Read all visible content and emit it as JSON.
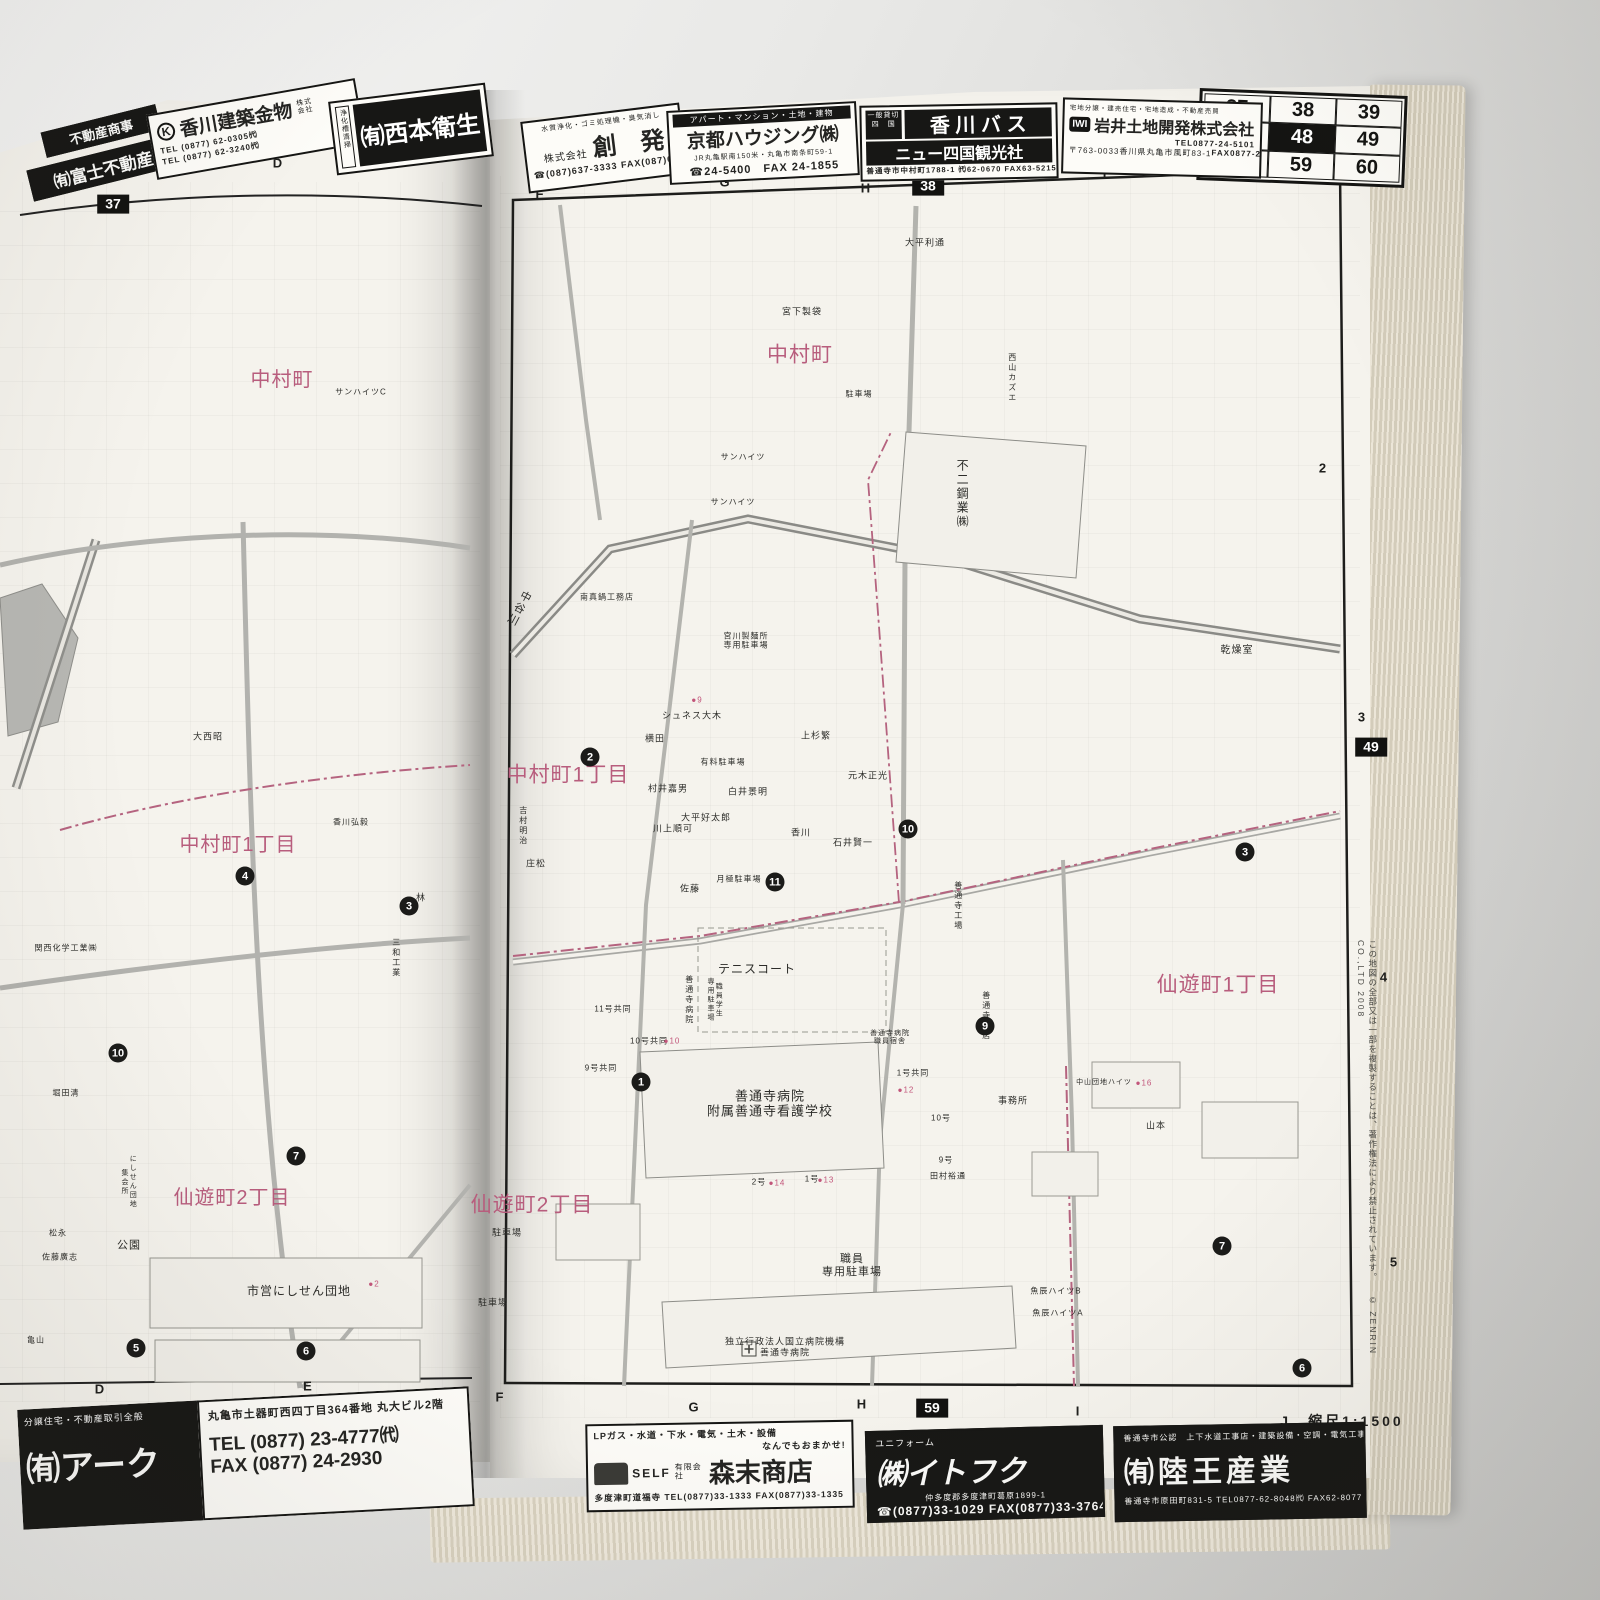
{
  "colors": {
    "pink": "#b85d7d",
    "red_dot": "#c2557a",
    "ink": "#1d1d1b",
    "page": "#f5f3ed"
  },
  "atlas": {
    "city": "善通寺市",
    "scale": "J　縮尺1:1500",
    "copyright_jp": "この地図の全部又は一部を複製することは、著作権法により禁止されています。",
    "copyright_en": "© ZENRIN CO.,LTD 2008"
  },
  "grid_index": {
    "cells": [
      {
        "text": "37"
      },
      {
        "text": "38"
      },
      {
        "text": "39"
      },
      {
        "text": "47"
      },
      {
        "text": "48",
        "active": true
      },
      {
        "text": "49"
      },
      {
        "text": "58"
      },
      {
        "text": "59"
      },
      {
        "text": "60"
      }
    ]
  },
  "page_boxes": [
    {
      "text": "37",
      "x": 113,
      "y": 204
    },
    {
      "text": "38",
      "x": 928,
      "y": 186
    },
    {
      "text": "49",
      "x": 1371,
      "y": 747
    },
    {
      "text": "59",
      "x": 932,
      "y": 1408
    }
  ],
  "grid_marks": [
    {
      "text": "D",
      "x": 278,
      "y": 163
    },
    {
      "text": "F",
      "x": 540,
      "y": 194
    },
    {
      "text": "G",
      "x": 725,
      "y": 182
    },
    {
      "text": "H",
      "x": 866,
      "y": 188
    },
    {
      "text": "I",
      "x": 1105,
      "y": 173
    },
    {
      "text": "J",
      "x": 1247,
      "y": 170
    },
    {
      "text": "善通寺市",
      "x": 1284,
      "y": 176,
      "size": 10
    },
    {
      "text": "2",
      "x": 1323,
      "y": 468
    },
    {
      "text": "3",
      "x": 1362,
      "y": 717
    },
    {
      "text": "4",
      "x": 1384,
      "y": 977
    },
    {
      "text": "5",
      "x": 1394,
      "y": 1262
    },
    {
      "text": "D",
      "x": 100,
      "y": 1389
    },
    {
      "text": "E",
      "x": 308,
      "y": 1386
    },
    {
      "text": "F",
      "x": 500,
      "y": 1397
    },
    {
      "text": "G",
      "x": 694,
      "y": 1407
    },
    {
      "text": "H",
      "x": 862,
      "y": 1404
    },
    {
      "text": "I",
      "x": 1078,
      "y": 1411
    }
  ],
  "right_map": {
    "labels": [
      {
        "text": "中村町",
        "x": 800,
        "y": 356,
        "size": 21,
        "color": "#b85d7d"
      },
      {
        "text": "中村町1丁目",
        "x": 568,
        "y": 776,
        "size": 21,
        "color": "#b85d7d"
      },
      {
        "text": "仙遊町1丁目",
        "x": 1218,
        "y": 986,
        "size": 21,
        "color": "#b85d7d"
      },
      {
        "text": "仙遊町2丁目",
        "x": 532,
        "y": 1206,
        "size": 21,
        "color": "#b85d7d"
      },
      {
        "text": "大平利通",
        "x": 925,
        "y": 243
      },
      {
        "text": "宮下製袋",
        "x": 802,
        "y": 312
      },
      {
        "text": "駐車場",
        "x": 859,
        "y": 394,
        "size": 8
      },
      {
        "text": "西山カズエ",
        "x": 1012,
        "y": 378,
        "vertical": true,
        "size": 8
      },
      {
        "text": "不二鋼業㈱",
        "x": 962,
        "y": 494,
        "vertical": true,
        "size": 12
      },
      {
        "text": "乾燥室",
        "x": 1237,
        "y": 651,
        "size": 10
      },
      {
        "text": "中谷川",
        "x": 518,
        "y": 608,
        "size": 11,
        "vertical": true,
        "rotate": 28
      },
      {
        "text": "南真鍋工務店",
        "x": 607,
        "y": 597,
        "size": 8
      },
      {
        "text": "サンハイツ",
        "x": 743,
        "y": 457,
        "size": 8
      },
      {
        "text": "サンハイツ",
        "x": 733,
        "y": 502,
        "size": 8
      },
      {
        "text": "宮川製麺所\n専用駐車場",
        "x": 746,
        "y": 641,
        "size": 8
      },
      {
        "text": "シュネス大木",
        "x": 692,
        "y": 716
      },
      {
        "text": "●9",
        "x": 697,
        "y": 700,
        "size": 8,
        "color": "#c2557a"
      },
      {
        "text": "有料駐車場",
        "x": 723,
        "y": 762,
        "size": 8
      },
      {
        "text": "横田",
        "x": 655,
        "y": 739
      },
      {
        "text": "村井嘉男",
        "x": 668,
        "y": 789
      },
      {
        "text": "白井景明",
        "x": 748,
        "y": 792
      },
      {
        "text": "大平好太郎",
        "x": 706,
        "y": 818
      },
      {
        "text": "川上順可",
        "x": 673,
        "y": 829
      },
      {
        "text": "上杉繁",
        "x": 816,
        "y": 736
      },
      {
        "text": "元木正光",
        "x": 868,
        "y": 776
      },
      {
        "text": "香川",
        "x": 801,
        "y": 833
      },
      {
        "text": "石井賢一",
        "x": 853,
        "y": 843
      },
      {
        "text": "月極駐車場",
        "x": 739,
        "y": 879,
        "size": 8
      },
      {
        "text": "佐藤",
        "x": 690,
        "y": 889
      },
      {
        "text": "庄松",
        "x": 536,
        "y": 864
      },
      {
        "text": "吉村明治",
        "x": 523,
        "y": 826,
        "vertical": true,
        "size": 8
      },
      {
        "text": "善通寺工場",
        "x": 958,
        "y": 906,
        "vertical": true,
        "size": 8
      },
      {
        "text": "善通寺支店",
        "x": 986,
        "y": 1016,
        "vertical": true,
        "size": 8
      },
      {
        "text": "テニスコート",
        "x": 757,
        "y": 969,
        "size": 12
      },
      {
        "text": "善通寺病院",
        "x": 689,
        "y": 1000,
        "vertical": true,
        "size": 8
      },
      {
        "text": "職員学生\n専用駐車場",
        "x": 714,
        "y": 1000,
        "vertical": true,
        "size": 7
      },
      {
        "text": "11号共同",
        "x": 613,
        "y": 1009,
        "size": 8
      },
      {
        "text": "10号共同",
        "x": 649,
        "y": 1041,
        "size": 8
      },
      {
        "text": "●10",
        "x": 672,
        "y": 1041,
        "size": 8,
        "color": "#c2557a"
      },
      {
        "text": "9号共同",
        "x": 601,
        "y": 1068,
        "size": 8
      },
      {
        "text": "善通寺病院\n職員宿舎",
        "x": 890,
        "y": 1038,
        "size": 7
      },
      {
        "text": "1号共同",
        "x": 913,
        "y": 1073,
        "size": 8
      },
      {
        "text": "●12",
        "x": 906,
        "y": 1090,
        "size": 8,
        "color": "#c2557a"
      },
      {
        "text": "10号",
        "x": 941,
        "y": 1118,
        "size": 8
      },
      {
        "text": "9号",
        "x": 946,
        "y": 1160,
        "size": 8
      },
      {
        "text": "田村裕通",
        "x": 948,
        "y": 1176,
        "size": 8
      },
      {
        "text": "善通寺病院\n附属善通寺看護学校",
        "x": 770,
        "y": 1104,
        "size": 13
      },
      {
        "text": "2号",
        "x": 759,
        "y": 1182,
        "size": 8
      },
      {
        "text": "●14",
        "x": 777,
        "y": 1183,
        "size": 8,
        "color": "#c2557a"
      },
      {
        "text": "1号",
        "x": 812,
        "y": 1179,
        "size": 8
      },
      {
        "text": "●13",
        "x": 826,
        "y": 1180,
        "size": 8,
        "color": "#c2557a"
      },
      {
        "text": "駐車場",
        "x": 507,
        "y": 1233
      },
      {
        "text": "駐車場",
        "x": 493,
        "y": 1303
      },
      {
        "text": "職員\n専用駐車場",
        "x": 852,
        "y": 1266,
        "size": 11
      },
      {
        "text": "独立行政法人国立病院機構\n善通寺病院",
        "x": 785,
        "y": 1347
      },
      {
        "text": "事務所",
        "x": 1013,
        "y": 1101
      },
      {
        "text": "中山団地ハイツ",
        "x": 1104,
        "y": 1083,
        "size": 7
      },
      {
        "text": "●16",
        "x": 1144,
        "y": 1083,
        "size": 8,
        "color": "#c2557a"
      },
      {
        "text": "山本",
        "x": 1156,
        "y": 1126
      },
      {
        "text": "魚辰ハイツB",
        "x": 1056,
        "y": 1291,
        "size": 8
      },
      {
        "text": "魚辰ハイツA",
        "x": 1058,
        "y": 1313,
        "size": 8
      }
    ],
    "markers": [
      {
        "n": "2",
        "x": 590,
        "y": 757
      },
      {
        "n": "11",
        "x": 775,
        "y": 882
      },
      {
        "n": "10",
        "x": 908,
        "y": 829
      },
      {
        "n": "9",
        "x": 985,
        "y": 1026
      },
      {
        "n": "1",
        "x": 641,
        "y": 1082
      },
      {
        "n": "3",
        "x": 1245,
        "y": 852
      },
      {
        "n": "7",
        "x": 1222,
        "y": 1246
      },
      {
        "n": "6",
        "x": 1302,
        "y": 1368
      }
    ]
  },
  "left_map": {
    "labels": [
      {
        "text": "中村町",
        "x": 282,
        "y": 381,
        "size": 20,
        "color": "#b85d7d"
      },
      {
        "text": "中村町1丁目",
        "x": 238,
        "y": 846,
        "size": 20,
        "color": "#b85d7d"
      },
      {
        "text": "仙遊町2丁目",
        "x": 232,
        "y": 1199,
        "size": 20,
        "color": "#b85d7d"
      },
      {
        "text": "サンハイツC",
        "x": 361,
        "y": 392,
        "size": 8
      },
      {
        "text": "大西昭",
        "x": 208,
        "y": 737
      },
      {
        "text": "関西化学工業㈱",
        "x": 66,
        "y": 948,
        "size": 8
      },
      {
        "text": "香川弘毅",
        "x": 351,
        "y": 822,
        "size": 8
      },
      {
        "text": "林",
        "x": 421,
        "y": 898
      },
      {
        "text": "三和工業",
        "x": 396,
        "y": 958,
        "vertical": true,
        "size": 8
      },
      {
        "text": "公園",
        "x": 129,
        "y": 1246,
        "size": 11
      },
      {
        "text": "市営にしせん団地",
        "x": 299,
        "y": 1291,
        "size": 12
      },
      {
        "text": "●2",
        "x": 374,
        "y": 1284,
        "size": 8,
        "color": "#c2557a"
      },
      {
        "text": "にしせん団地\n集会所",
        "x": 128,
        "y": 1182,
        "vertical": true,
        "size": 7
      },
      {
        "text": "松永",
        "x": 58,
        "y": 1233,
        "size": 8
      },
      {
        "text": "佐藤廣志",
        "x": 60,
        "y": 1257,
        "size": 8
      },
      {
        "text": "堀田清",
        "x": 66,
        "y": 1093,
        "size": 8
      },
      {
        "text": "亀山",
        "x": 36,
        "y": 1340,
        "size": 8
      }
    ],
    "markers": [
      {
        "n": "4",
        "x": 245,
        "y": 876
      },
      {
        "n": "3",
        "x": 409,
        "y": 906
      },
      {
        "n": "10",
        "x": 118,
        "y": 1053
      },
      {
        "n": "7",
        "x": 296,
        "y": 1156
      },
      {
        "n": "5",
        "x": 136,
        "y": 1348
      },
      {
        "n": "6",
        "x": 306,
        "y": 1351
      }
    ]
  },
  "ads_top": {
    "fuji": {
      "box1": "不動産商事",
      "box2": "㈲富士不動産"
    },
    "kenchiku": {
      "logo": "K",
      "name": "香川建築金物",
      "company": "株式会社",
      "tel1": "TEL (0877) 62-0305㈹",
      "tel2": "TEL (0877) 62-3240㈹"
    },
    "nishimoto": {
      "side": "浄化槽清掃",
      "name": "㈲西本衛生"
    },
    "souhatsu": {
      "tagline": "水質浄化・ゴミ処理機・臭気消し",
      "prefix": "株式会社",
      "name": "創　発",
      "tel": "☎(087)637-3333 FAX(087)637-2700"
    },
    "kyoto": {
      "tagline": "アパート・マンション・土地・建物",
      "name": "京都ハウジング㈱",
      "addr": "JR丸亀駅南150米・丸亀市南条町59-1",
      "tel": "☎24-5400　FAX 24-1855"
    },
    "bus": {
      "badge": "一般貸切\n四　国",
      "name": "香 川 バ ス",
      "name2": "ニュー四国観光社",
      "addr": "善通寺市中村町1788-1 ㈹62-0670 FAX63-5215"
    },
    "iwai": {
      "logo": "IWI",
      "tiny": "宅地分譲・建売住宅・宅地造成・不動産売買",
      "name": "岩井土地開発株式会社",
      "post": "〒763-0033",
      "addr": "香川県丸亀市風町83-1",
      "tel": "TEL0877-24-5101",
      "fax": "FAX0877-24-5110"
    }
  },
  "ads_bottom": {
    "ark": {
      "tagline": "分譲住宅・不動産取引全般",
      "name": "㈲アーク",
      "addr": "丸亀市土器町西四丁目364番地 丸大ビル2階",
      "tel": "TEL (0877) 23-4777㈹",
      "fax": "FAX (0877) 24-2930"
    },
    "morisue": {
      "tagline": "LPガス・水道・下水・電気・土木・設備",
      "tagline2": "なんでもおまかせ!",
      "self": "SELF",
      "prefix": "有限会社",
      "name": "森末商店",
      "addr": "多度津町道福寺 TEL(0877)33-1333 FAX(0877)33-1335"
    },
    "itofuku": {
      "tagline": "ユニフォーム",
      "name": "㈱イトフク",
      "addr": "仲多度郡多度津町葛原1899-1",
      "tel": "☎(0877)33-1029 FAX(0877)33-3764"
    },
    "rikuoh": {
      "tagline": "善通寺市公認　上下水道工事店・建築設備・空調・電気工事",
      "name": "㈲陸王産業",
      "addr": "善通寺市原田町831-5 TEL0877-62-8048㈹ FAX62-8077"
    }
  }
}
